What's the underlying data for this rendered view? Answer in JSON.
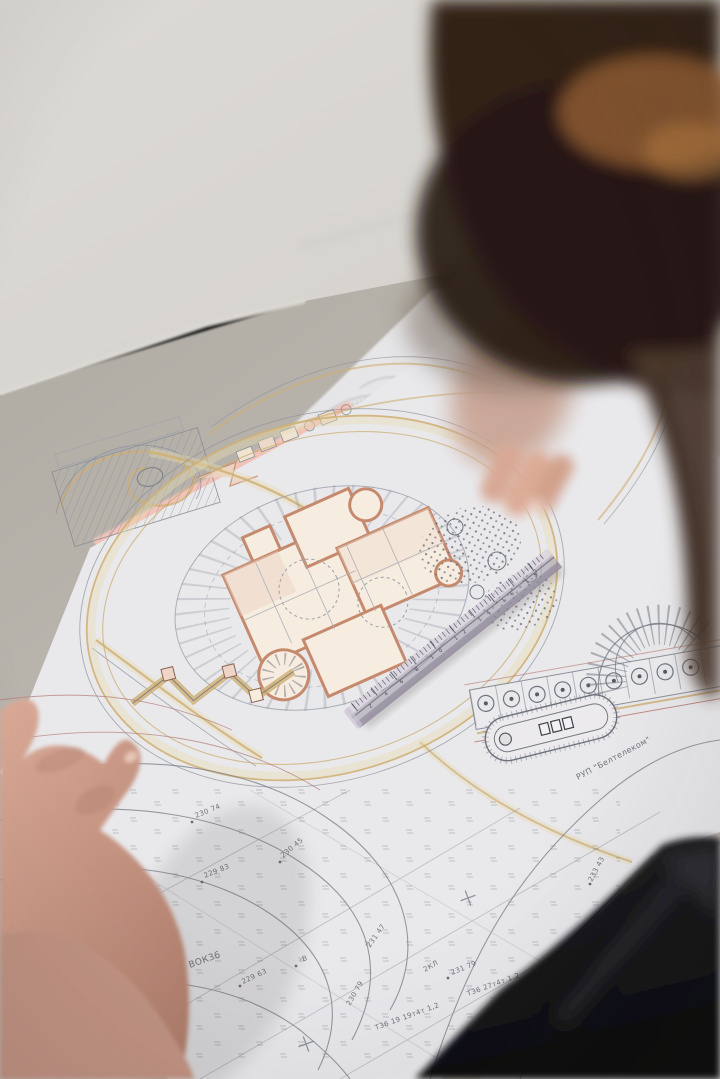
{
  "scene": {
    "colors": {
      "wall": "#d9d7d3",
      "desk": "#b4afa7",
      "paper": "#e9e9ec",
      "sticky_note": "#f4c6bd",
      "hair_dark": "#322014",
      "hair_highlight": "#9a6436",
      "shirt": "#141417",
      "skin": "#cf9f8f",
      "ruler_body": "#a79fae",
      "plan_wall_salmon": "#c58a6e",
      "plan_road_tan": "#cfae72",
      "plan_line_grey": "#868b96",
      "plan_accent_red": "#b5756a"
    }
  },
  "blueprint": {
    "type": "architectural site plan with topographic survey",
    "labels": [
      {
        "text": "230 74"
      },
      {
        "text": "230 25"
      },
      {
        "text": "229 83"
      },
      {
        "text": "230 45"
      },
      {
        "text": "231 47"
      },
      {
        "text": "230 79"
      },
      {
        "text": "2КЛ"
      },
      {
        "text": "231 79"
      },
      {
        "text": "ВОК36"
      },
      {
        "text": "229 63"
      },
      {
        "text": "-В"
      },
      {
        "text": "Т36 19 19т4т 1,2"
      },
      {
        "text": "Т36 27т4т 1,2"
      },
      {
        "text": "233 43"
      },
      {
        "text": "РУП \"Белтелеком\""
      }
    ]
  },
  "ruler": {
    "scale_numbers": "2 4 6 8 10 12 14 16 18"
  }
}
